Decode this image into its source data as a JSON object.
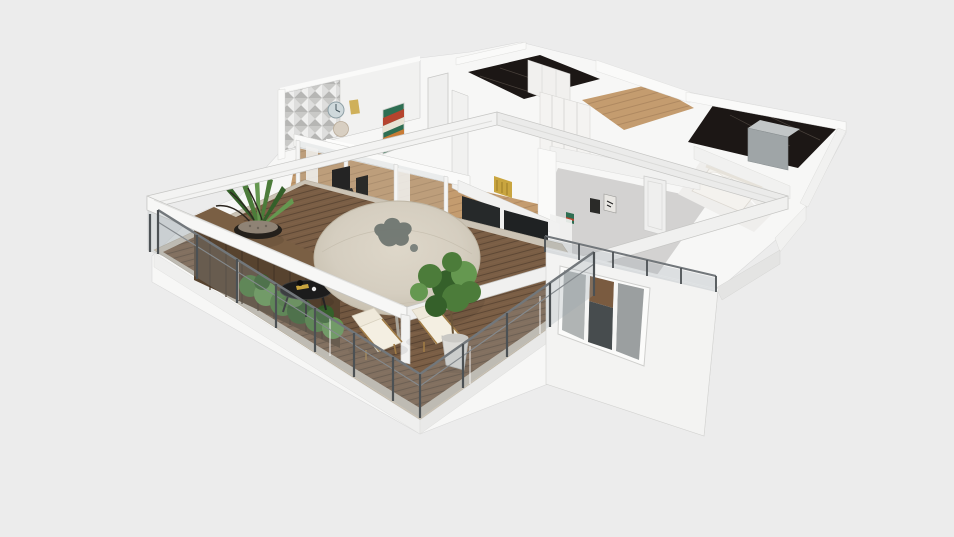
{
  "scene": {
    "type": "3d_floorplan_render",
    "view": "isometric bird's-eye cutaway of an apartment, seen from the southwest",
    "background": "plain light gray, no visible UI chrome or text",
    "rooms": [
      {
        "id": "terrace",
        "label": "terrace-balcony",
        "floor": "dark wood deck planks with pale stone edging",
        "objects": [
          "glass-railing-with-steel-posts",
          "white-pergola-frame",
          "round-beige-parasol-canopy",
          "gray-leaf-ornament-on-canopy",
          "parasol-pole",
          "dark-wood-planter-sideboard",
          "black-bowl-grass-plant",
          "green-hedge-planter",
          "twig-decor-vase",
          "round-black-coffee-table",
          "sun-lounger-1",
          "sun-lounger-2",
          "ficus-plant-in-white-pot",
          "white-steps"
        ]
      },
      {
        "id": "living-dining",
        "label": "living-dining-room",
        "floor": "light oak planks",
        "objects": [
          "sliding-glass-doors",
          "white-curtains",
          "triangle-mosaic-accent-wall",
          "wall-clock",
          "round-mirror",
          "chevron-wall-art",
          "black-dining-chairs",
          "gold-cabinet-art",
          "dark-glass-wall",
          "white-interior-door"
        ]
      },
      {
        "id": "hallway-closet",
        "label": "hallway-walk-in-closet",
        "floor": "light oak",
        "objects": [
          "white-wardrobe-fronts",
          "open-shelf-unit"
        ]
      },
      {
        "id": "bathroom-top",
        "label": "bathroom-black-marble",
        "floor": "black marble",
        "objects": [
          "white-closet-panels"
        ]
      },
      {
        "id": "bathroom-right",
        "label": "bathroom-with-shower",
        "floor": "black marble",
        "objects": [
          "gray-shower-enclosure"
        ]
      },
      {
        "id": "bedroom",
        "label": "bedroom",
        "floor": "gray",
        "objects": [
          "white-door",
          "wall-art-frames",
          "glass-balustrade",
          "triple-pane-window",
          "white-bed-with-pillows",
          "glossy-white-floor"
        ]
      }
    ],
    "exterior": [
      "white-walls",
      "white-base-slab",
      "triple-window-on-southwest-wall"
    ]
  },
  "palette": {
    "bg": "#ECECEC",
    "mass": "#F7F7F6",
    "wallBright": "#FAFAF9",
    "wall": "#F1F1F0",
    "wallShade": "#E4E4E3",
    "outline": "#C6C6C4",
    "deckWood": "#7A5E45",
    "deckPlankLine": "#5E4835",
    "deckEdge": "#CBC3B5",
    "darkWood": "#57432F",
    "darkWoodLine": "#463627",
    "plantGreen": "#4C7C3A",
    "plantGreenDark": "#35602A",
    "plantGreenLight": "#659850",
    "canopy": "#D5CEC0",
    "canopyEdge": "#BFB7A6",
    "ornament": "#6F7671",
    "marbleDark": "#1C1715",
    "marbleVein": "#4A423C",
    "oakFloor": "#C49C6F",
    "grayFloor": "#D3D2D1",
    "glossFloor": "#EFEEEC",
    "steel": "#4C5154",
    "railTop": "#72777B",
    "furnitureBlack": "#1C1C1C",
    "cushion": "#EFE9DA",
    "frameWood": "#A07C46",
    "potWhite": "#DCDBD7",
    "showerGray": "#9FA5A7",
    "gold": "#C9A53F",
    "artGreen": "#2E6E52",
    "artRed": "#B5442E",
    "artCream": "#E8E3D4",
    "artOrange": "#C97B35",
    "clockFace": "#CFD9DC",
    "mirror": "#D8CFC2",
    "curtain": "#F1F1F0",
    "doorWhite": "#EFEFEE",
    "bedWhite": "#F4F2EE",
    "darkGlass": "#26292A"
  }
}
